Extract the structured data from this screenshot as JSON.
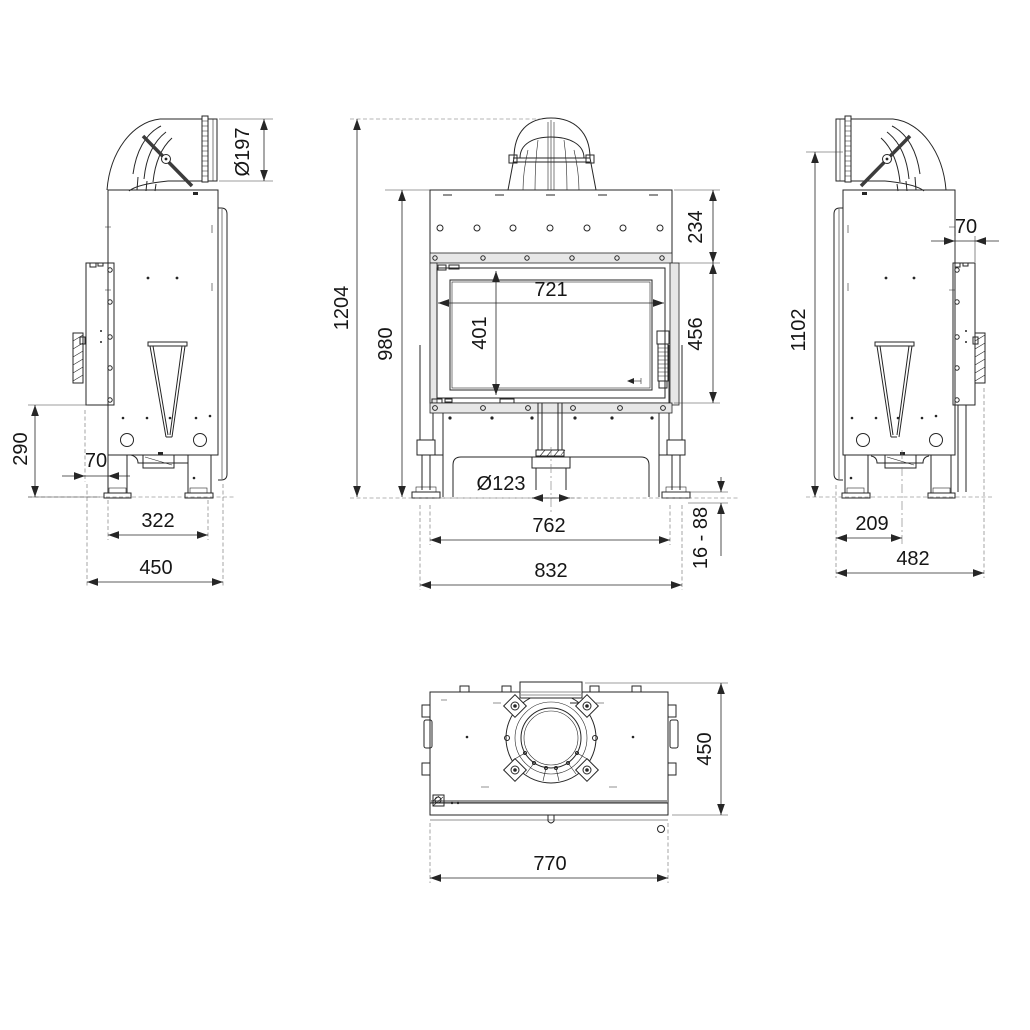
{
  "colors": {
    "line": "#262626",
    "background": "#ffffff"
  },
  "views": {
    "side_left": {
      "dims": {
        "flue_diameter": "Ø197",
        "rear_duct_height": "290",
        "rear_panel_depth": "70",
        "foot_spacing": "322",
        "overall_depth": "450"
      }
    },
    "front": {
      "dims": {
        "overall_height": "1204",
        "body_height": "980",
        "hood_height": "234",
        "door_height": "456",
        "glass_width": "721",
        "glass_height": "401",
        "air_inlet_diameter": "Ø123",
        "foot_spacing": "762",
        "overall_width": "832",
        "leg_adjustment_range": "16 - 88"
      }
    },
    "side_right": {
      "dims": {
        "flue_axis_height": "1102",
        "rear_panel_depth": "70",
        "outlet_offset": "209",
        "overall_depth": "482"
      }
    },
    "top": {
      "dims": {
        "overall_depth": "450",
        "body_width": "770"
      }
    }
  }
}
